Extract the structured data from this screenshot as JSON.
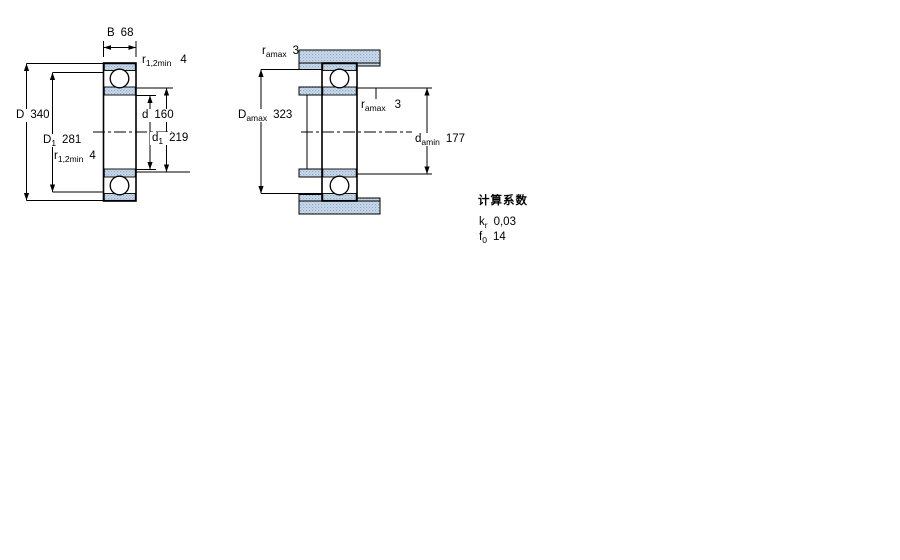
{
  "colors": {
    "line": "#000000",
    "hatch_fill": "#cbdbeb",
    "hatch_dot": "#8fa9c9",
    "background": "#ffffff"
  },
  "left_drawing": {
    "description": "bearing cross-section with boundary dimensions",
    "labels": {
      "width": {
        "base": "B",
        "value": "68"
      },
      "r_top": {
        "base": "r",
        "sub": "1,2min",
        "value": "4"
      },
      "outer_diameter": {
        "base": "D",
        "value": "340"
      },
      "shoulder_outer": {
        "base": "D",
        "sub": "1",
        "value": "281"
      },
      "r_bottom": {
        "base": "r",
        "sub": "1,2min",
        "value": "4"
      },
      "bore": {
        "base": "d",
        "value": "160"
      },
      "shoulder_inner": {
        "base": "d",
        "sub": "1",
        "value": "219"
      }
    }
  },
  "right_drawing": {
    "description": "mounted bearing with abutment dimensions",
    "labels": {
      "ra_top": {
        "base": "r",
        "sub": "amax",
        "value": "3"
      },
      "housing_abutment": {
        "base": "D",
        "sub": "amax",
        "value": "323"
      },
      "ra_mid": {
        "base": "r",
        "sub": "amax",
        "value": "3"
      },
      "shaft_abutment": {
        "base": "d",
        "sub": "amin",
        "value": "177"
      }
    }
  },
  "calculation_factors": {
    "title": "计算系数",
    "k": {
      "base": "k",
      "sub": "r",
      "value": "0,03"
    },
    "f": {
      "base": "f",
      "sub": "0",
      "value": "14"
    }
  }
}
